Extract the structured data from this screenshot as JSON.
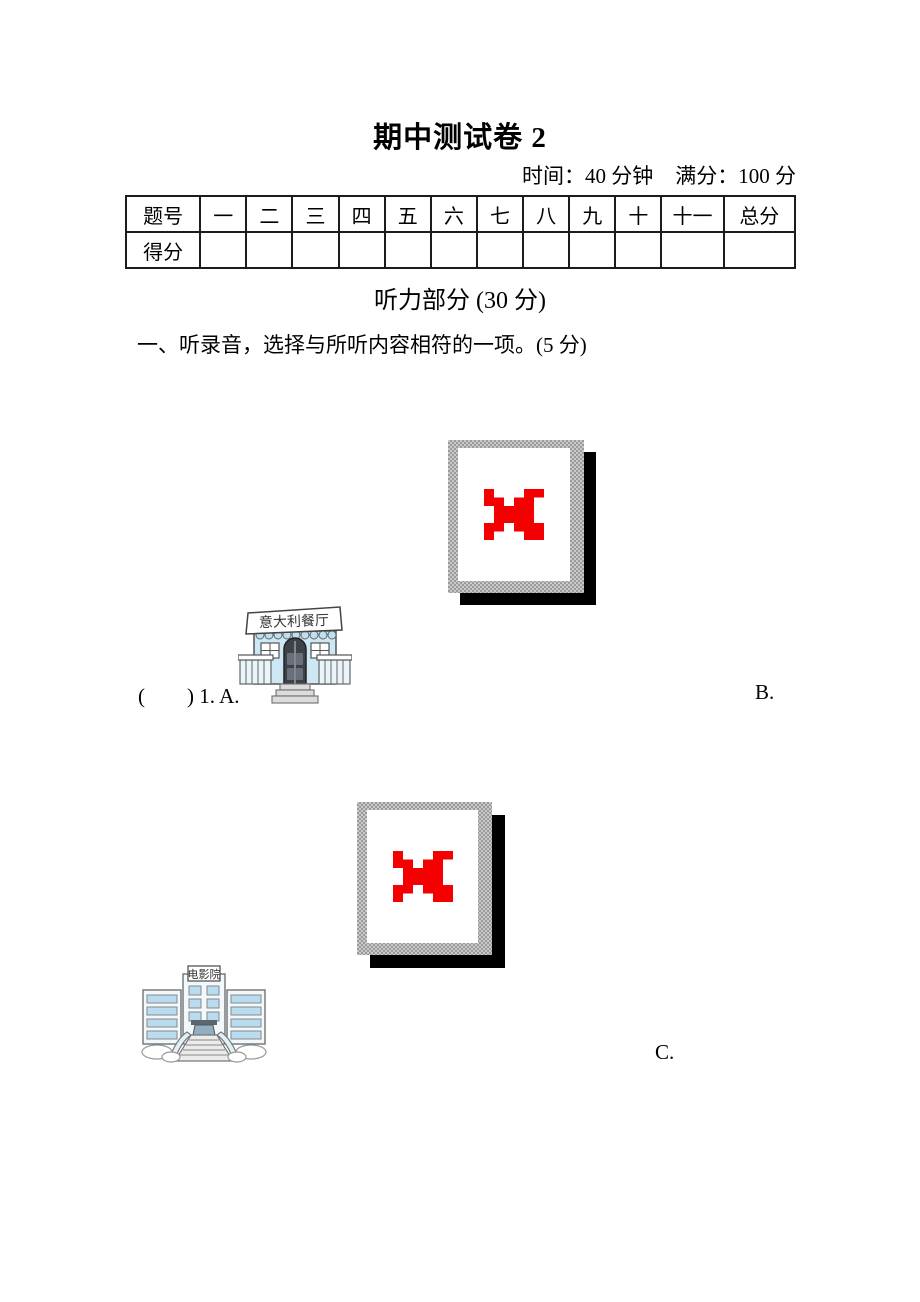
{
  "page": {
    "title": "期中测试卷 2",
    "meta_time": "时间：40 分钟",
    "meta_score": "满分：100 分"
  },
  "score_table": {
    "header_label": "题号",
    "score_label": "得分",
    "columns": [
      "一",
      "二",
      "三",
      "四",
      "五",
      "六",
      "七",
      "八",
      "九",
      "十",
      "十一",
      "总分"
    ]
  },
  "listening": {
    "section_title": "听力部分 (30 分)",
    "question1": {
      "prompt": "一、听录音，选择与所听内容相符的一项。(5 分)",
      "answer_prefix": "(　　) 1. A.",
      "option_b": "B.",
      "option_c": "C.",
      "restaurant_sign": "意大利餐厅",
      "cinema_sign": "电影院"
    }
  },
  "colors": {
    "broken_x_red": "#f40000",
    "frame_gray": "#a8a8a8",
    "shadow_black": "#000000",
    "building_blue": "#cde7f5",
    "window_blue": "#badcf0",
    "outline_gray": "#555555"
  }
}
